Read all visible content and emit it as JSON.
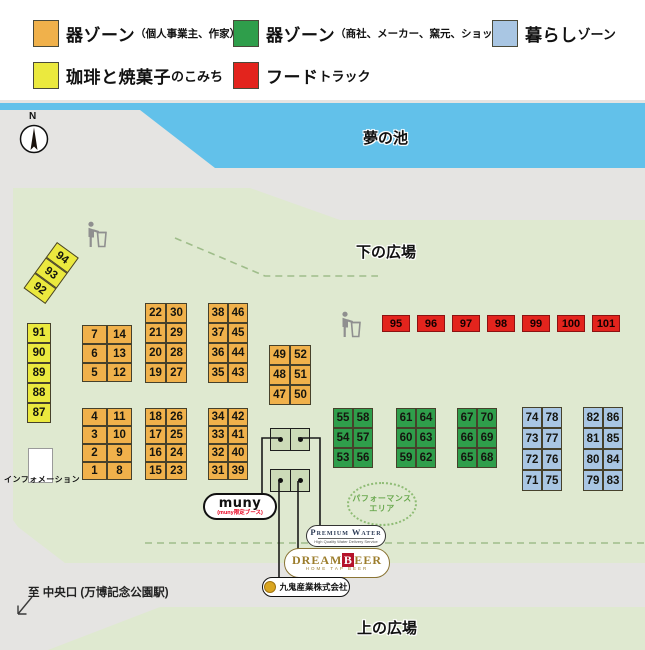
{
  "colors": {
    "orange": "#f0b14b",
    "green": "#2f9e4b",
    "blue": "#a9c6e3",
    "yellow": "#ebe93e",
    "red": "#e3241d",
    "pond": "#62c1ea",
    "field": "#dfe9d0",
    "bg_gray": "#e5e4e2",
    "dash_green": "#9fbd8a"
  },
  "legend": {
    "items": [
      {
        "name": "zone-utsuwa-individual",
        "color_key": "orange",
        "x": 33,
        "y": 20,
        "main": "器ゾーン",
        "small": "",
        "sub": "（個人事業主、作家）"
      },
      {
        "name": "zone-utsuwa-shop",
        "color_key": "green",
        "x": 233,
        "y": 20,
        "main": "器ゾーン",
        "small": "",
        "sub": "（商社、メーカー、窯元、ショップ）"
      },
      {
        "name": "zone-kurashi",
        "color_key": "blue",
        "x": 492,
        "y": 20,
        "main": "暮らし",
        "small": "ゾーン",
        "sub": ""
      },
      {
        "name": "zone-coffee-sweets",
        "color_key": "yellow",
        "x": 33,
        "y": 62,
        "main": "珈琲と焼菓子",
        "small": "のこみち",
        "sub": ""
      },
      {
        "name": "zone-food-truck",
        "color_key": "red",
        "x": 233,
        "y": 62,
        "main": "フード",
        "small": "トラック",
        "sub": ""
      }
    ]
  },
  "map": {
    "pond_label": "夢の池",
    "lower_plaza_label": "下の広場",
    "upper_plaza_label": "上の広場",
    "exit_label": "至 中央口 (万博記念公園駅)",
    "info_label": "インフォメーション",
    "performance_lines": [
      "パフォーマンス",
      "エリア"
    ],
    "compass_label": "N",
    "booth_groups": [
      {
        "name": "coffee-strip",
        "color_key": "yellow",
        "x": 57,
        "y": 242,
        "cell_w": 27,
        "cell_h": 19,
        "rotate": 36,
        "rows": [
          [
            "94"
          ],
          [
            "93"
          ],
          [
            "92"
          ]
        ]
      },
      {
        "name": "coffee-column",
        "color_key": "yellow",
        "x": 27,
        "y": 323,
        "cell_w": 24,
        "cell_h": 20,
        "rotate": 0,
        "rows": [
          [
            "91"
          ],
          [
            "90"
          ],
          [
            "89"
          ],
          [
            "88"
          ],
          [
            "87"
          ]
        ]
      },
      {
        "name": "pottery-a1",
        "color_key": "orange",
        "x": 82,
        "y": 325,
        "cell_w": 25,
        "cell_h": 19,
        "rotate": 0,
        "rows": [
          [
            "7",
            "14"
          ],
          [
            "6",
            "13"
          ],
          [
            "5",
            "12"
          ]
        ]
      },
      {
        "name": "pottery-a2",
        "color_key": "orange",
        "x": 82,
        "y": 408,
        "cell_w": 25,
        "cell_h": 18,
        "rotate": 0,
        "rows": [
          [
            "4",
            "11"
          ],
          [
            "3",
            "10"
          ],
          [
            "2",
            "9"
          ],
          [
            "1",
            "8"
          ]
        ]
      },
      {
        "name": "pottery-b1",
        "color_key": "orange",
        "x": 145,
        "y": 303,
        "cell_w": 21,
        "cell_h": 20,
        "rotate": 0,
        "rows": [
          [
            "22",
            "30"
          ],
          [
            "21",
            "29"
          ],
          [
            "20",
            "28"
          ],
          [
            "19",
            "27"
          ]
        ]
      },
      {
        "name": "pottery-b2",
        "color_key": "orange",
        "x": 145,
        "y": 408,
        "cell_w": 21,
        "cell_h": 18,
        "rotate": 0,
        "rows": [
          [
            "18",
            "26"
          ],
          [
            "17",
            "25"
          ],
          [
            "16",
            "24"
          ],
          [
            "15",
            "23"
          ]
        ]
      },
      {
        "name": "pottery-c1",
        "color_key": "orange",
        "x": 208,
        "y": 303,
        "cell_w": 20,
        "cell_h": 20,
        "rotate": 0,
        "rows": [
          [
            "38",
            "46"
          ],
          [
            "37",
            "45"
          ],
          [
            "36",
            "44"
          ],
          [
            "35",
            "43"
          ]
        ]
      },
      {
        "name": "pottery-c2",
        "color_key": "orange",
        "x": 208,
        "y": 408,
        "cell_w": 20,
        "cell_h": 18,
        "rotate": 0,
        "rows": [
          [
            "34",
            "42"
          ],
          [
            "33",
            "41"
          ],
          [
            "32",
            "40"
          ],
          [
            "31",
            "39"
          ]
        ]
      },
      {
        "name": "pottery-d",
        "color_key": "orange",
        "x": 269,
        "y": 345,
        "cell_w": 21,
        "cell_h": 20,
        "rotate": 0,
        "rows": [
          [
            "49",
            "52"
          ],
          [
            "48",
            "51"
          ],
          [
            "47",
            "50"
          ]
        ]
      },
      {
        "name": "maker-1",
        "color_key": "green",
        "x": 333,
        "y": 408,
        "cell_w": 20,
        "cell_h": 20,
        "rotate": 0,
        "rows": [
          [
            "55",
            "58"
          ],
          [
            "54",
            "57"
          ],
          [
            "53",
            "56"
          ]
        ]
      },
      {
        "name": "maker-2",
        "color_key": "green",
        "x": 396,
        "y": 408,
        "cell_w": 20,
        "cell_h": 20,
        "rotate": 0,
        "rows": [
          [
            "61",
            "64"
          ],
          [
            "60",
            "63"
          ],
          [
            "59",
            "62"
          ]
        ]
      },
      {
        "name": "maker-3",
        "color_key": "green",
        "x": 457,
        "y": 408,
        "cell_w": 20,
        "cell_h": 20,
        "rotate": 0,
        "rows": [
          [
            "67",
            "70"
          ],
          [
            "66",
            "69"
          ],
          [
            "65",
            "68"
          ]
        ]
      },
      {
        "name": "living-1",
        "color_key": "blue",
        "x": 522,
        "y": 407,
        "cell_w": 20,
        "cell_h": 21,
        "rotate": 0,
        "rows": [
          [
            "74",
            "78"
          ],
          [
            "73",
            "77"
          ],
          [
            "72",
            "76"
          ],
          [
            "71",
            "75"
          ]
        ]
      },
      {
        "name": "living-2",
        "color_key": "blue",
        "x": 583,
        "y": 407,
        "cell_w": 20,
        "cell_h": 21,
        "rotate": 0,
        "rows": [
          [
            "82",
            "86"
          ],
          [
            "81",
            "85"
          ],
          [
            "80",
            "84"
          ],
          [
            "79",
            "83"
          ]
        ]
      }
    ],
    "food_trucks": {
      "x": 382,
      "y": 315,
      "cell_w": 28,
      "cell_h": 17,
      "gap": 7,
      "numbers": [
        "95",
        "96",
        "97",
        "98",
        "99",
        "100",
        "101"
      ]
    },
    "sponsor_booths": [
      {
        "x": 270,
        "y": 428,
        "w": 38,
        "h": 21
      },
      {
        "x": 270,
        "y": 469,
        "w": 38,
        "h": 21
      }
    ],
    "connector_lines": [
      [
        [
          279,
          438
        ],
        [
          262,
          438
        ],
        [
          262,
          494
        ]
      ],
      [
        [
          298,
          438
        ],
        [
          320,
          438
        ],
        [
          320,
          528
        ]
      ],
      [
        [
          298,
          481
        ],
        [
          298,
          550
        ]
      ],
      [
        [
          279,
          481
        ],
        [
          279,
          579
        ]
      ]
    ],
    "dashed_paths": [
      "M175,238 L265,276 L378,276",
      "M145,543 L645,543"
    ],
    "sponsors": {
      "muny": {
        "label": "muny",
        "sub": "(muny限定ブース)"
      },
      "premium_water": {
        "label": "Premium Water",
        "sub": "High Quality Water Delivery Service"
      },
      "dreambeer": {
        "left": "DREAM",
        "b": "B",
        "right": "EER",
        "sub": "HOME TAP BEER"
      },
      "kuki": {
        "label": "九鬼産業株式会社"
      }
    }
  }
}
